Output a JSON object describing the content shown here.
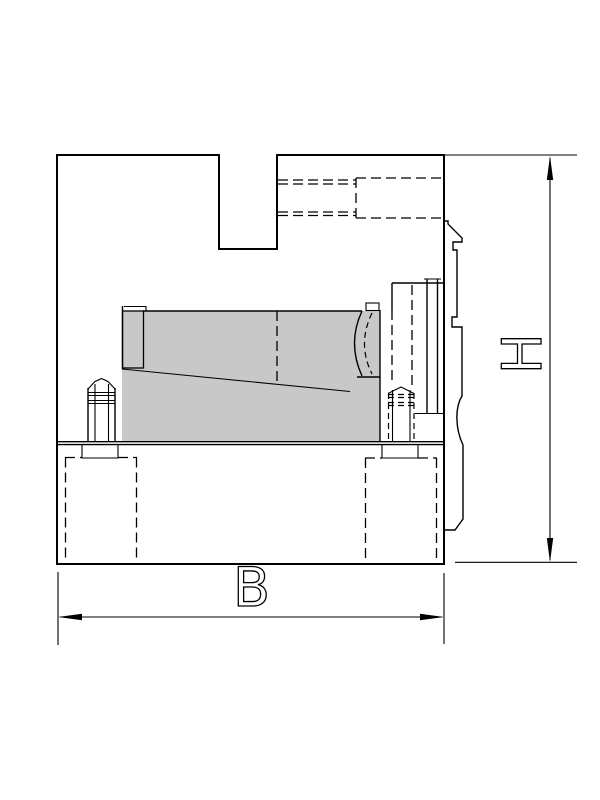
{
  "drawing": {
    "type": "technical-cross-section",
    "description": "Sectional view of a clamping block with tapered bore, mounting screws and spindle flange",
    "colors": {
      "body_fill": "#818181",
      "insert_fill": "#c8c8c8",
      "cavity_fill": "#ffffff",
      "line": "#000000",
      "background": "#ffffff"
    },
    "dimensions": [
      {
        "label": "B",
        "orientation": "horizontal",
        "measures": "overall width"
      },
      {
        "label": "H",
        "orientation": "vertical",
        "measures": "overall height"
      }
    ]
  }
}
